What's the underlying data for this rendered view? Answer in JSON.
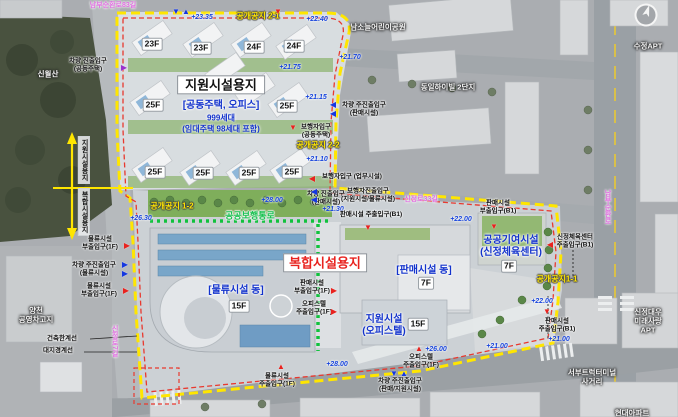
{
  "zones": {
    "support_site": {
      "title": "지원시설용지",
      "subtitle": "[공동주택, 오피스]",
      "units": "999세대",
      "units_note": "(임대주택 98세대 포함)"
    },
    "complex_site": {
      "title": "복합시설용지"
    },
    "logistics": {
      "name": "[물류시설 동]"
    },
    "retail": {
      "name": "[판매시설 동]"
    },
    "public_contribution": {
      "name": "공공기여시설\n(신정체육센터)"
    },
    "officetel": {
      "name": "지원시설\n(오피스텔)"
    }
  },
  "walkway_label": "공공보행통로",
  "open_spaces": [
    {
      "t": "공개공지 2-1",
      "x": 258,
      "y": 16
    },
    {
      "t": "공개공지 2-2",
      "x": 318,
      "y": 145
    },
    {
      "t": "공개공지 1-2",
      "x": 172,
      "y": 206
    },
    {
      "t": "공개공지1-1",
      "x": 557,
      "y": 279
    }
  ],
  "floors": [
    {
      "t": "23F",
      "x": 152,
      "y": 44
    },
    {
      "t": "23F",
      "x": 201,
      "y": 48
    },
    {
      "t": "24F",
      "x": 254,
      "y": 47
    },
    {
      "t": "24F",
      "x": 294,
      "y": 46
    },
    {
      "t": "25F",
      "x": 153,
      "y": 105
    },
    {
      "t": "25F",
      "x": 287,
      "y": 106
    },
    {
      "t": "25F",
      "x": 155,
      "y": 172
    },
    {
      "t": "25F",
      "x": 203,
      "y": 173
    },
    {
      "t": "25F",
      "x": 249,
      "y": 173
    },
    {
      "t": "25F",
      "x": 292,
      "y": 172
    },
    {
      "t": "15F",
      "x": 239,
      "y": 306
    },
    {
      "t": "7F",
      "x": 426,
      "y": 283
    },
    {
      "t": "7F",
      "x": 509,
      "y": 266
    },
    {
      "t": "15F",
      "x": 418,
      "y": 324
    }
  ],
  "elevations": [
    {
      "t": "+23.35",
      "x": 202,
      "y": 18
    },
    {
      "t": "+22.40",
      "x": 317,
      "y": 20
    },
    {
      "t": "+21.70",
      "x": 350,
      "y": 58
    },
    {
      "t": "+21.75",
      "x": 290,
      "y": 68
    },
    {
      "t": "+21.15",
      "x": 316,
      "y": 98
    },
    {
      "t": "+21.10",
      "x": 317,
      "y": 160
    },
    {
      "t": "+26.30",
      "x": 141,
      "y": 219
    },
    {
      "t": "+28.00",
      "x": 272,
      "y": 201
    },
    {
      "t": "+21.30",
      "x": 333,
      "y": 210
    },
    {
      "t": "+22.00",
      "x": 461,
      "y": 220
    },
    {
      "t": "+22.00",
      "x": 542,
      "y": 302
    },
    {
      "t": "+21.00",
      "x": 559,
      "y": 340
    },
    {
      "t": "+26.00",
      "x": 436,
      "y": 350
    },
    {
      "t": "+28.00",
      "x": 337,
      "y": 365
    },
    {
      "t": "+21.00",
      "x": 497,
      "y": 347
    }
  ],
  "entrances": [
    {
      "t": "차량 진출입구\n(공동주택)",
      "x": 88,
      "y": 65
    },
    {
      "t": "보행자입구\n(공동주택)",
      "x": 316,
      "y": 131
    },
    {
      "t": "차량 주진출입구\n(판매시설)",
      "x": 364,
      "y": 109
    },
    {
      "t": "보행자입구 (업무시설)",
      "x": 352,
      "y": 177
    },
    {
      "t": "물류시설\n부출입구(1F)",
      "x": 100,
      "y": 243
    },
    {
      "t": "차량 주진출입구\n(물류시설)",
      "x": 94,
      "y": 269
    },
    {
      "t": "물류시설\n부출입구(1F)",
      "x": 99,
      "y": 290
    },
    {
      "t": "판매시설\n부출입구(1F)",
      "x": 312,
      "y": 287
    },
    {
      "t": "오피스텔\n주출입구(1F)",
      "x": 314,
      "y": 308
    },
    {
      "t": "물류시설\n주출입구(1F)",
      "x": 277,
      "y": 380
    },
    {
      "t": "차량 진출입구\n(판매시설)",
      "x": 326,
      "y": 198
    },
    {
      "t": "보행자진출입구\n(지원시설/물류시설)",
      "x": 368,
      "y": 195
    },
    {
      "t": "판매시설 주출입구(B1)",
      "x": 371,
      "y": 215
    },
    {
      "t": "판매시설\n부출입구(B1)",
      "x": 498,
      "y": 207
    },
    {
      "t": "신정체육센터\n주출입구(B1)",
      "x": 575,
      "y": 241
    },
    {
      "t": "판매시설\n주출입구(B1)",
      "x": 557,
      "y": 325
    },
    {
      "t": "오피스텔\n주출입구(1F)",
      "x": 421,
      "y": 361
    },
    {
      "t": "차량 주진출입구\n(판매/지원시설)",
      "x": 400,
      "y": 385
    }
  ],
  "markers": [
    {
      "d": "down",
      "c": "blue",
      "x": 176,
      "y": 12
    },
    {
      "d": "up",
      "c": "blue",
      "x": 186,
      "y": 12
    },
    {
      "d": "down",
      "c": "red",
      "x": 278,
      "y": 12
    },
    {
      "d": "right",
      "c": "purple",
      "x": 124,
      "y": 68
    },
    {
      "d": "down",
      "c": "red",
      "x": 293,
      "y": 128
    },
    {
      "d": "left",
      "c": "blue",
      "x": 333,
      "y": 105
    },
    {
      "d": "left",
      "c": "blue",
      "x": 333,
      "y": 114
    },
    {
      "d": "left",
      "c": "red",
      "x": 312,
      "y": 179
    },
    {
      "d": "right",
      "c": "red",
      "x": 127,
      "y": 246
    },
    {
      "d": "right",
      "c": "blue",
      "x": 125,
      "y": 265
    },
    {
      "d": "right",
      "c": "blue",
      "x": 125,
      "y": 274
    },
    {
      "d": "right",
      "c": "red",
      "x": 126,
      "y": 291
    },
    {
      "d": "right",
      "c": "red",
      "x": 334,
      "y": 291
    },
    {
      "d": "right",
      "c": "red",
      "x": 334,
      "y": 312
    },
    {
      "d": "up",
      "c": "red",
      "x": 281,
      "y": 367
    },
    {
      "d": "left",
      "c": "blue",
      "x": 314,
      "y": 192
    },
    {
      "d": "left",
      "c": "blue",
      "x": 314,
      "y": 200
    },
    {
      "d": "down",
      "c": "red",
      "x": 368,
      "y": 228
    },
    {
      "d": "down",
      "c": "red",
      "x": 494,
      "y": 227
    },
    {
      "d": "left",
      "c": "red",
      "x": 550,
      "y": 245
    },
    {
      "d": "down",
      "c": "red",
      "x": 547,
      "y": 312
    },
    {
      "d": "up",
      "c": "red",
      "x": 419,
      "y": 349
    },
    {
      "d": "down",
      "c": "blue",
      "x": 394,
      "y": 374
    },
    {
      "d": "up",
      "c": "blue",
      "x": 404,
      "y": 374
    }
  ],
  "surroundings": [
    {
      "t": "신월산",
      "x": 48,
      "y": 75
    },
    {
      "t": "남소늘어린이공원",
      "x": 378,
      "y": 28
    },
    {
      "t": "동일하이빌 2단지",
      "x": 448,
      "y": 88
    },
    {
      "t": "수정APT",
      "x": 648,
      "y": 47
    },
    {
      "t": "양천\n공영차고지",
      "x": 36,
      "y": 316
    },
    {
      "t": "신정대우\n미래사랑\nAPT",
      "x": 648,
      "y": 322
    },
    {
      "t": "서부트럭터미널\n사거리",
      "x": 592,
      "y": 378
    },
    {
      "t": "현대아파트",
      "x": 632,
      "y": 414
    }
  ],
  "roads": [
    {
      "t": "남부순환로83길",
      "x": 113,
      "y": 6
    },
    {
      "t": "신정로33길",
      "x": 421,
      "y": 200
    },
    {
      "t": "남부순환로",
      "x": 607,
      "y": 207,
      "vert": true
    },
    {
      "t": "신정로7길",
      "x": 114,
      "y": 341,
      "vert": true
    }
  ],
  "sections": [
    {
      "t": "지원시설용지",
      "x": 84,
      "y": 160,
      "vert": true
    },
    {
      "t": "복합시설용지",
      "x": 84,
      "y": 212,
      "vert": true
    }
  ],
  "legend": [
    {
      "t": "건축한계선",
      "x": 62,
      "y": 339
    },
    {
      "t": "대지경계선",
      "x": 58,
      "y": 351
    }
  ],
  "colors": {
    "boundary_yellow": "#ffe600",
    "boundary_red": "#e8392f",
    "walkway_green": "#10c23d",
    "elevation_blue": "#1744dd",
    "zone_blue": "#1333cc",
    "complex_red": "#e8231f",
    "road_pink": "#e06ee0"
  }
}
